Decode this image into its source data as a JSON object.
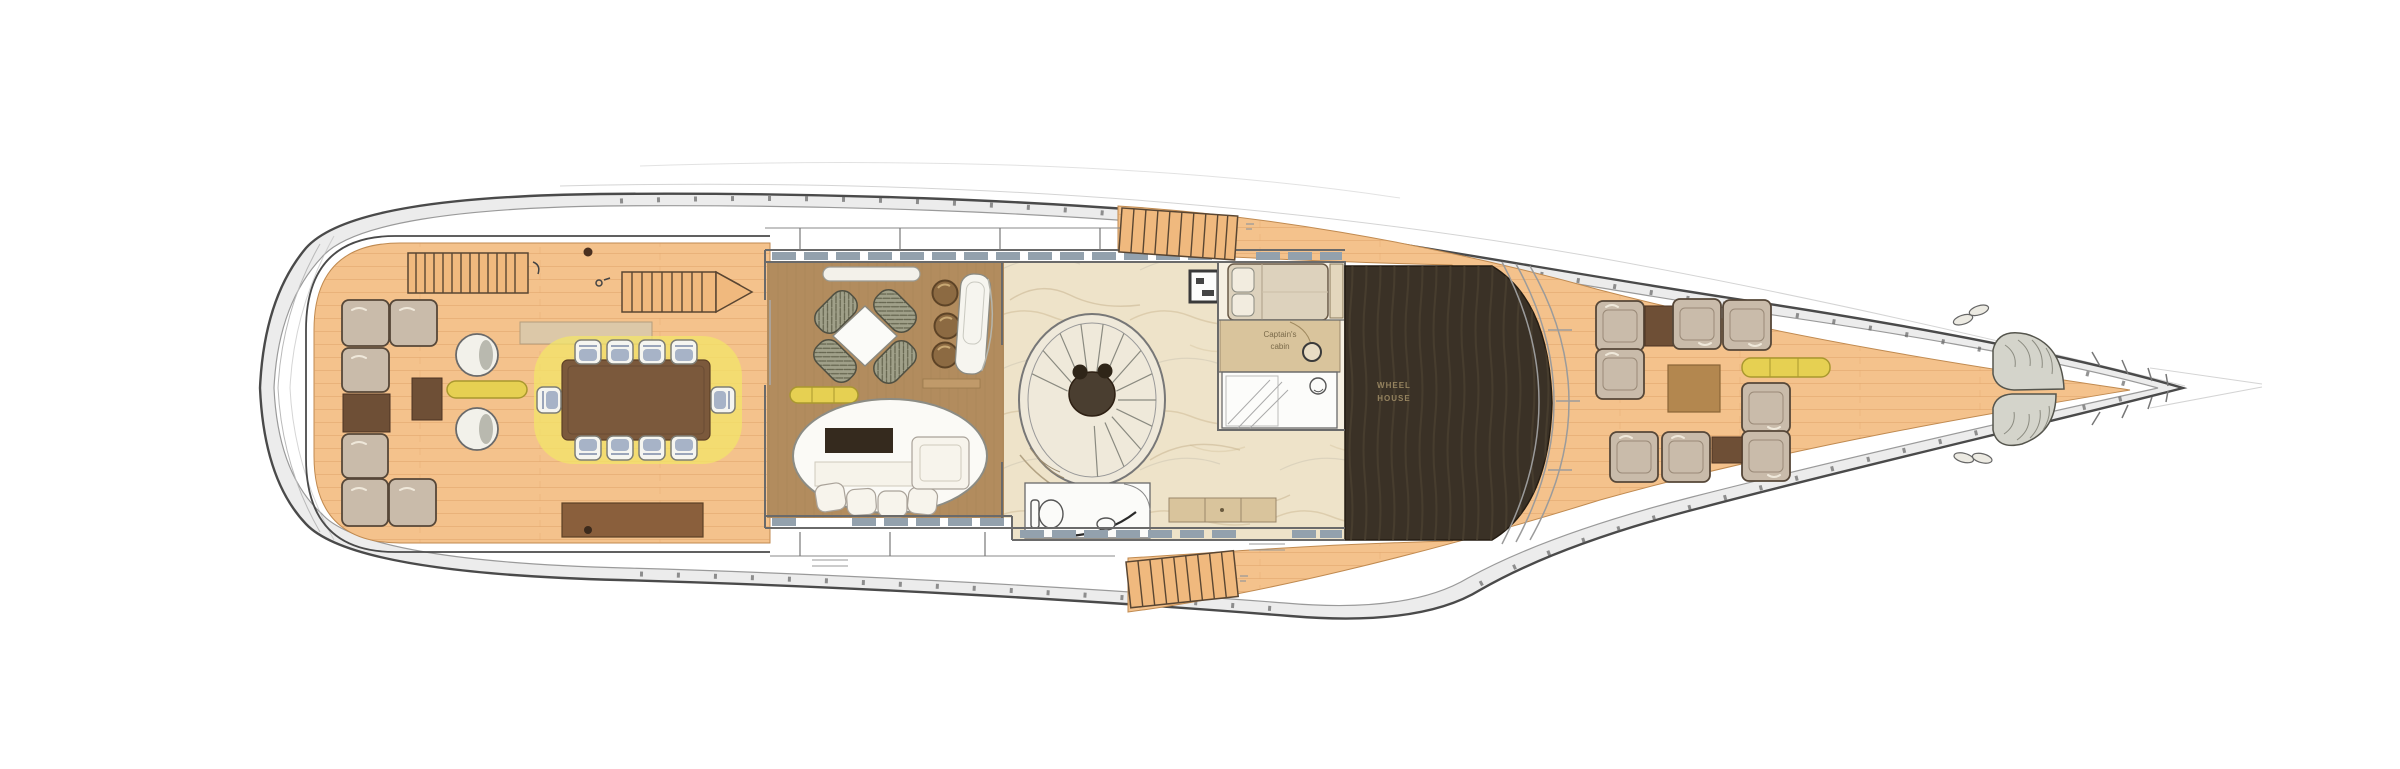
{
  "page": {
    "background_color": "#ffffff"
  },
  "plan": {
    "kind": "yacht-deck-floor-plan",
    "orientation": "bow-right",
    "labels": {
      "captain_cabin_line1": "Captain's",
      "captain_cabin_line2": "cabin",
      "wheelhouse_line1": "WHEEL",
      "wheelhouse_line2": "HOUSE"
    },
    "colors": {
      "deck-teak": "#f4c28c",
      "deck-plank": "#d99a5e",
      "lounge-floor": "#b28c5e",
      "lobby-floor": "#eee3c9",
      "hull-outline": "#4a4a4a",
      "hull-inner-line": "#9a9a9a",
      "hull-rim": "#ececec",
      "window-glass": "#93a1ad",
      "wall": "#6a6a6a",
      "cushion": "#c9bbaa",
      "cushion-outline": "#564738",
      "wood-dark": "#6e4f36",
      "wood-table": "#7b593c",
      "wood-cabinet": "#8a5f3c",
      "wood-light": "#b3874f",
      "sideboard-tan": "#dcc8a8",
      "desk-tan": "#d9c49c",
      "yellow": "#e6d052",
      "yellow-outline": "#a9982e",
      "halo-yellow": "#f3e468",
      "chair-white": "#f5f5f0",
      "chair-blue": "#93a2bd",
      "stool-brown": "#8c6a42",
      "stair-teak": "#f0b97e",
      "stair-rung": "#5a4632",
      "glass-dark": "#3a3126",
      "glass-text": "#95835f",
      "bed": "#ddd2bd",
      "desk-tan2": "#d9c49c",
      "fixture-white": "#fbfbf9"
    },
    "components": [
      "hull",
      "aft-deck",
      "aft-deck-sectional-sofa",
      "aft-round-chairs",
      "aft-dining-table-10-chairs",
      "aft-stairs",
      "sky-lounge",
      "card-table-4-chairs",
      "bar-stools",
      "chaise-longue",
      "oval-lounge-sofa-tv",
      "spiral-staircase",
      "day-head",
      "captain-cabin",
      "captain-ensuite",
      "wheelhouse-skylight",
      "windshield",
      "side-stairways",
      "foredeck-lounge",
      "bow-seat-cushions",
      "bow-cleats"
    ]
  }
}
